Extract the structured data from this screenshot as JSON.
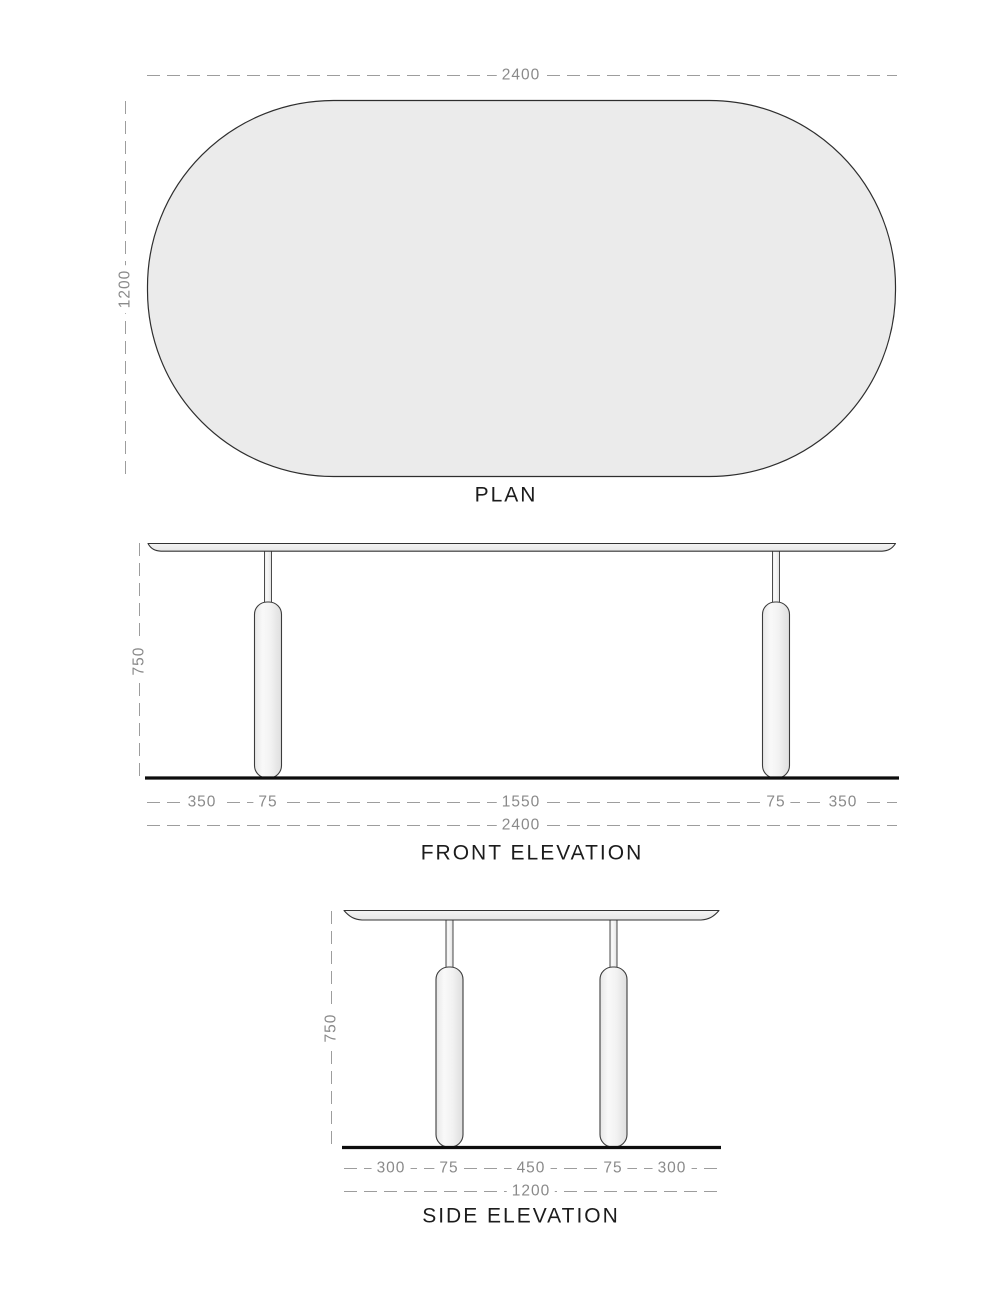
{
  "drawing": {
    "plan": {
      "title": "PLAN",
      "width_dim": "2400",
      "depth_dim": "1200"
    },
    "front_elevation": {
      "title": "FRONT ELEVATION",
      "height_dim": "750",
      "overall_dim": "2400",
      "segment_dims": [
        "350",
        "75",
        "1550",
        "75",
        "350"
      ]
    },
    "side_elevation": {
      "title": "SIDE ELEVATION",
      "height_dim": "750",
      "overall_dim": "1200",
      "segment_dims": [
        "300",
        "75",
        "450",
        "75",
        "300"
      ]
    },
    "colors": {
      "outline": "#333333",
      "dimension_text": "#8a8a8a",
      "dashed_line": "#9d9d9d",
      "surface_fill": "#ebebeb",
      "floor_line": "#0d0d0d"
    }
  }
}
